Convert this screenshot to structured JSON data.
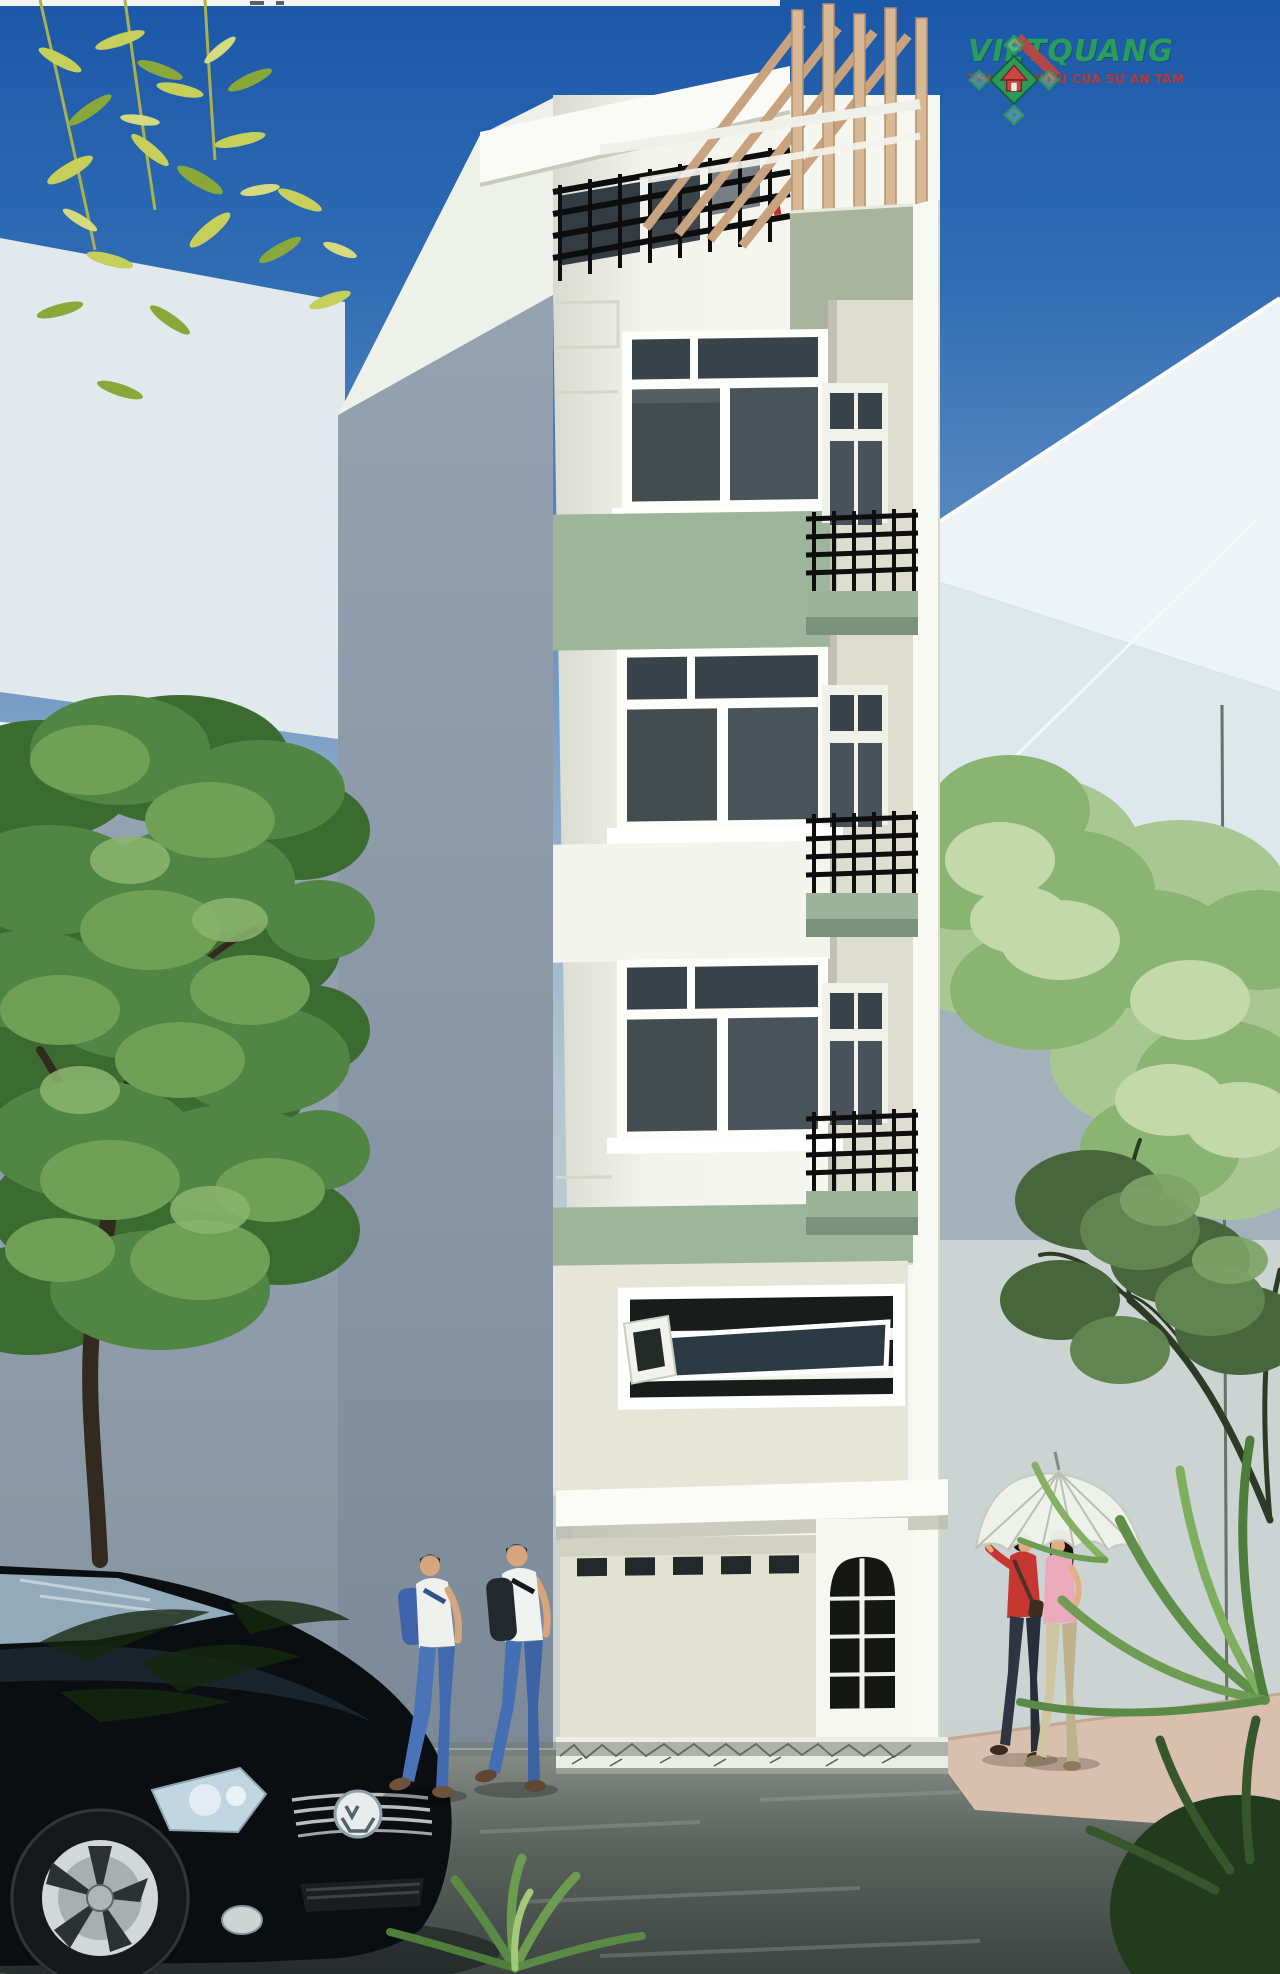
{
  "image": {
    "kind": "3D architectural rendering",
    "subject": "Narrow 5-storey street-front townhouse (nha pho) exterior perspective",
    "width_px": 1280,
    "height_px": 1974
  },
  "logo": {
    "brand": "VIETQUANG",
    "tagline": "THƯƠNG HIỆU CỦA SỰ AN TÂM",
    "brand_color": "#2aa257",
    "tagline_color": "#bf3a30",
    "emblem": "diamond-lattice-with-red-house"
  },
  "palette": {
    "sky_top": "#1c58a8",
    "sky_horizon": "#c8d2d2",
    "facade_white": "#f3f4ee",
    "facade_accent_green": "#9db59b",
    "side_wall_grey": "#8b98a7",
    "ground_floor_cream": "#e2e2d2",
    "window_glass": "#414a4c",
    "railing_black": "#101010",
    "pergola_wood": "#d5b28d",
    "road_asphalt": "#4a524f",
    "sidewalk_pink": "#d9bfad",
    "tree_green": "#518543",
    "car_black": "#0b0e10"
  },
  "scene": {
    "background": [
      "gradient blue sky",
      "pale abstract building planes",
      "grey-blue walls"
    ],
    "building": {
      "storeys": 5,
      "features": [
        "rooftop pergola with timber posts and rafters",
        "roof terrace with black metal railing and dark glass",
        "three white-framed windows with dark glazing",
        "sage-green accent bands",
        "right-side recessed balconies with black railings and green slabs",
        "mezzanine strip window with open awning panes",
        "white entry canopy",
        "arched glazed entry door with white muntin grid",
        "row of small transom vent windows"
      ]
    },
    "foreground": [
      "black Volkswagen hatchback, front three-quarter view",
      "two men walking with backpacks, white shirts and blue jeans",
      "two women strolling under a white umbrella, red and pink tops",
      "street tree with dense green canopy on the left",
      "yellow-green bamboo foliage at top left",
      "light green trees and a branching tree on the right",
      "dracaena and agave plants at bottom right and centre",
      "grey asphalt road and pink paved sidewalk"
    ]
  }
}
